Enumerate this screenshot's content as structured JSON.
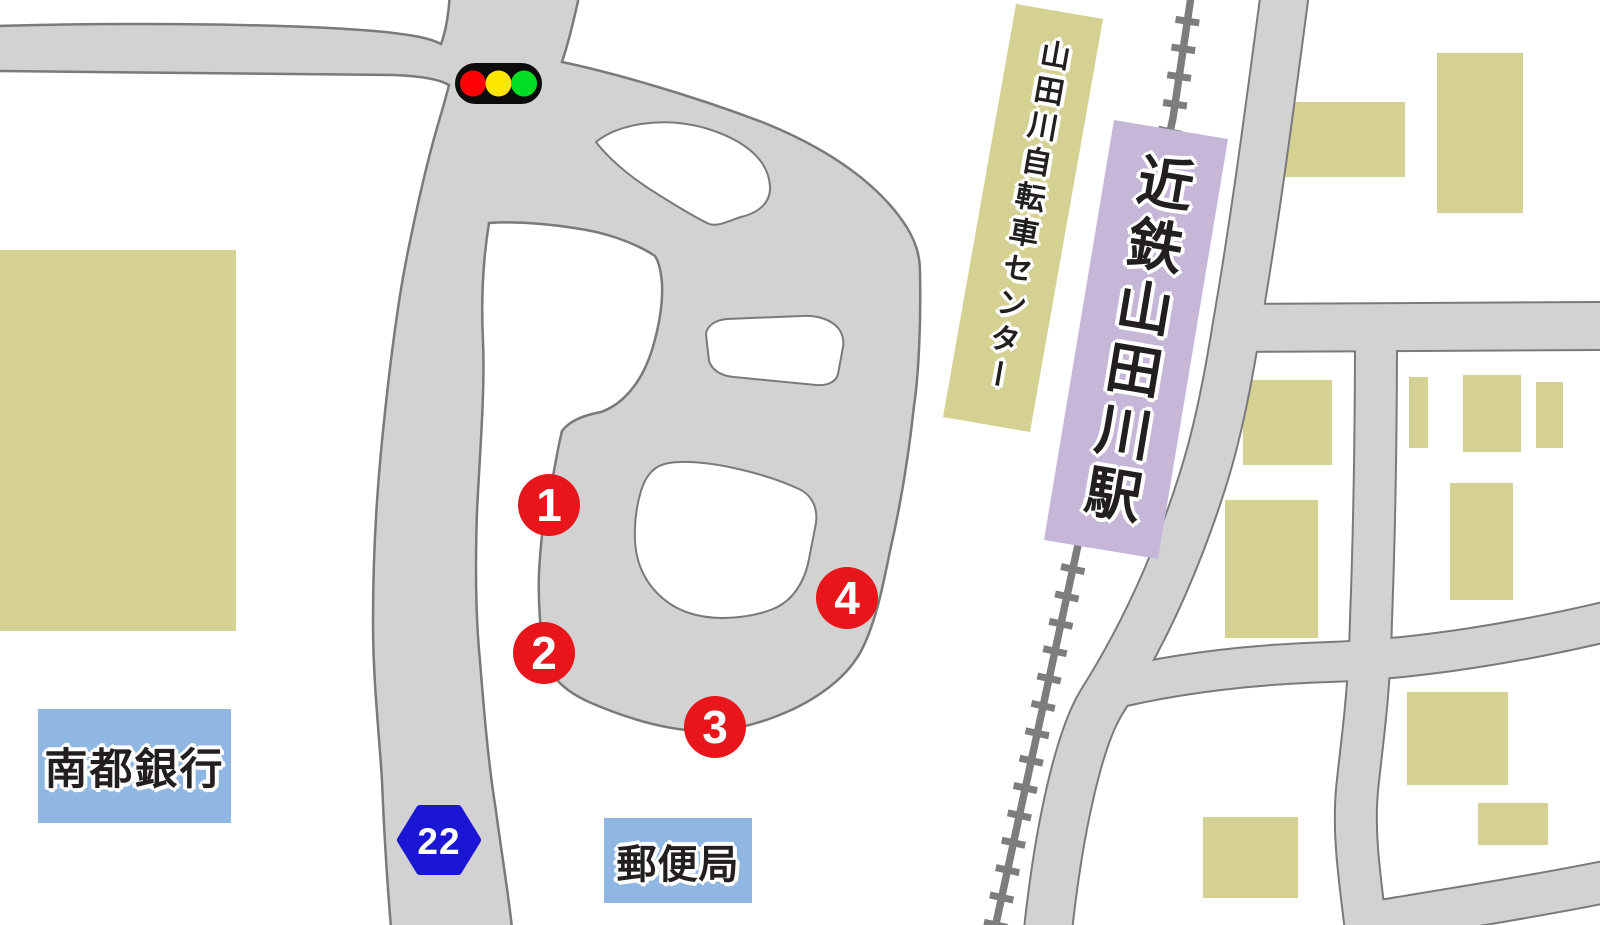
{
  "station": {
    "name": "近鉄山田川駅",
    "building_color": "#c6b6d7"
  },
  "bicycle_center": {
    "name": "山田川自転車センター",
    "building_color": "#d4d192"
  },
  "bank": {
    "name": "南都銀行",
    "label_bg": "#8fb7e2"
  },
  "post_office": {
    "name": "郵便局",
    "label_bg": "#8fb7e2"
  },
  "route_badge": {
    "number": "22",
    "color": "#1b16d4"
  },
  "bus_stops": [
    {
      "number": "1"
    },
    {
      "number": "2"
    },
    {
      "number": "3"
    },
    {
      "number": "4"
    }
  ],
  "icons": {
    "traffic_light": "traffic-light-icon",
    "railway": "railway-line-with-ties"
  },
  "map_colors": {
    "road_fill": "#d2d2d2",
    "road_outline": "#7a7a7a",
    "building_fill": "#d4d192",
    "railway_gray": "#7d7d7d",
    "marker_red": "#e8151b",
    "traffic_red": "#ff0004",
    "traffic_yellow": "#ffe600",
    "traffic_green": "#00dd22",
    "background": "#ffffff"
  }
}
